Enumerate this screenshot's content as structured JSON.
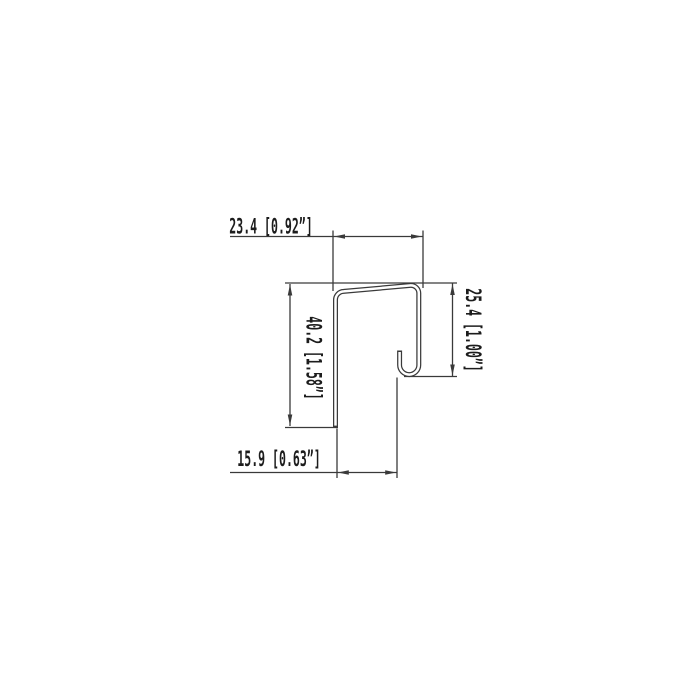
{
  "drawing": {
    "background": "#ffffff",
    "line_color": "#3a3a3a",
    "text_color": "#1c1c1c",
    "dimensions": {
      "top": "23.4 [0.92”]",
      "right": "25.4 [1.00”]",
      "left": "40.2 [1.58”]",
      "bottom": "15.9 [0.63”]"
    }
  }
}
